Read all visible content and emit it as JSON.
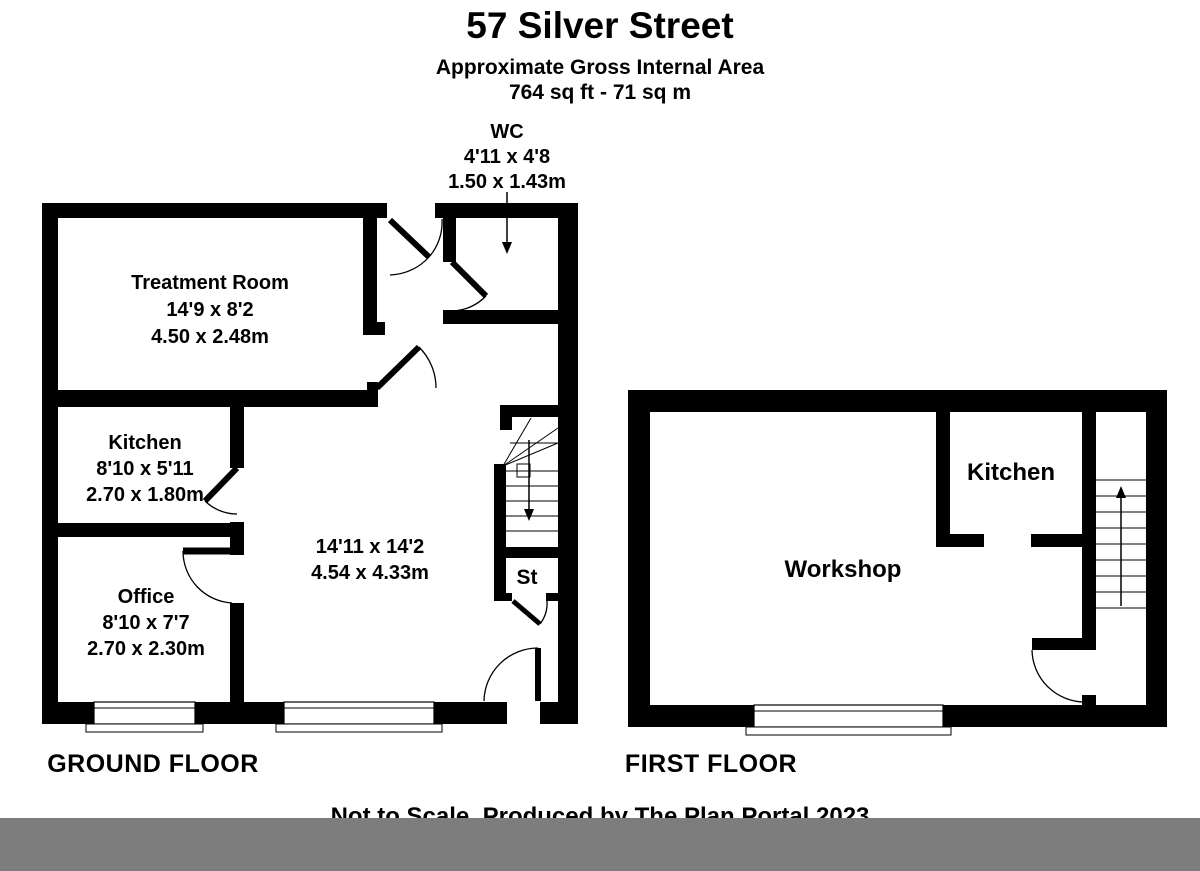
{
  "header": {
    "title": "57 Silver Street",
    "subtitle": "Approximate Gross Internal Area",
    "area": "764 sq ft - 71 sq m"
  },
  "wc": {
    "name": "WC",
    "size_imperial": "4'11 x 4'8",
    "size_metric": "1.50 x 1.43m"
  },
  "ground_floor": {
    "title": "GROUND FLOOR",
    "rooms": {
      "treatment_room": {
        "name": "Treatment Room",
        "size_imperial": "14'9 x 8'2",
        "size_metric": "4.50 x 2.48m"
      },
      "kitchen": {
        "name": "Kitchen",
        "size_imperial": "8'10 x 5'11",
        "size_metric": "2.70 x 1.80m"
      },
      "office": {
        "name": "Office",
        "size_imperial": "8'10 x 7'7",
        "size_metric": "2.70 x 2.30m"
      },
      "main_room": {
        "size_imperial": "14'11 x 14'2",
        "size_metric": "4.54 x 4.33m"
      },
      "store": {
        "name": "St"
      }
    }
  },
  "first_floor": {
    "title": "FIRST FLOOR",
    "rooms": {
      "workshop": {
        "name": "Workshop"
      },
      "kitchen": {
        "name": "Kitchen"
      }
    }
  },
  "footer": {
    "note": "Not to Scale. Produced by The Plan Portal 2023"
  },
  "colors": {
    "walls": "#000000",
    "footer_bar": "#7d7d7d",
    "background": "#ffffff"
  }
}
